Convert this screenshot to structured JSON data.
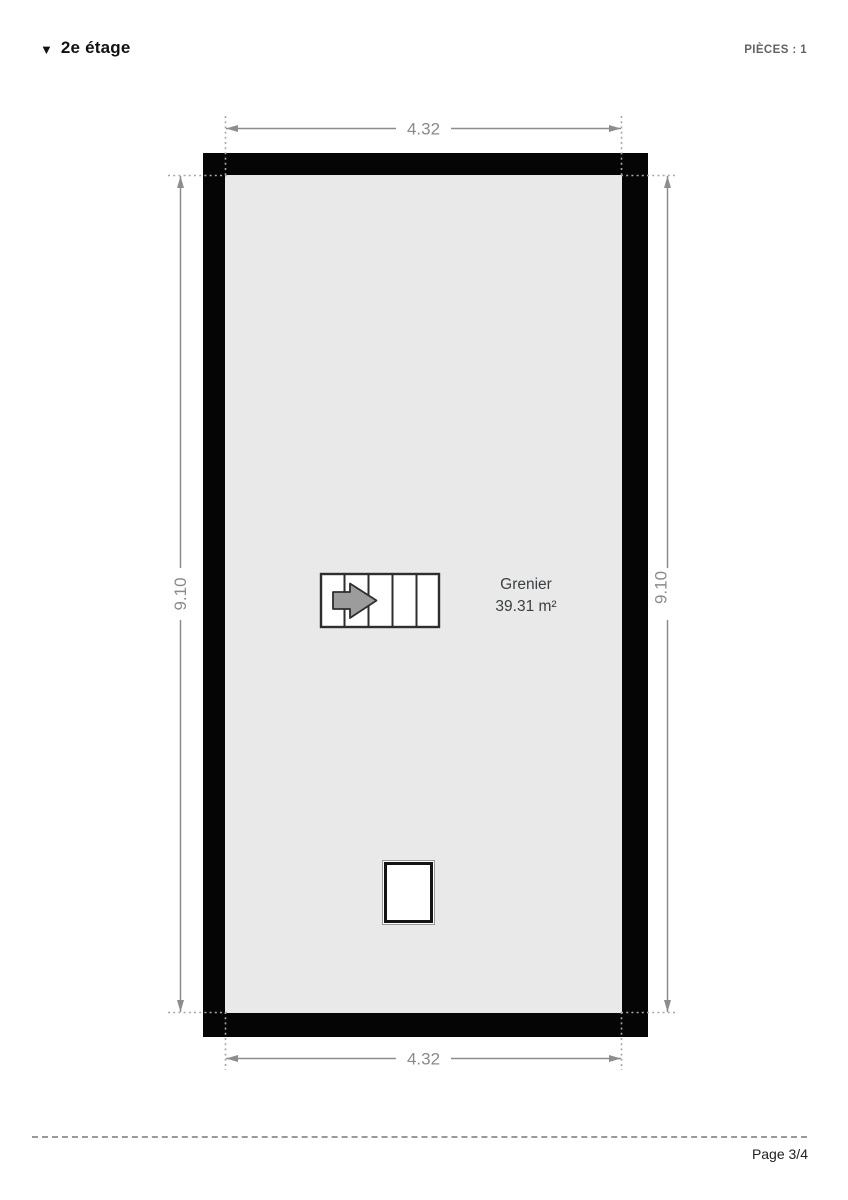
{
  "header": {
    "collapse_icon": "▼",
    "floor_title": "2e étage",
    "rooms_count_label": "PIÈCES : 1"
  },
  "plan": {
    "room": {
      "name": "Grenier",
      "area": "39.31 m²"
    },
    "dimensions": {
      "top_width": "4.32",
      "bottom_width": "4.32",
      "left_height": "9.10",
      "right_height": "9.10"
    }
  },
  "footer": {
    "page_label": "Page 3/4"
  },
  "colors": {
    "wall": "#050505",
    "floor": "#e9e9e9",
    "dimension_gray": "#8d8d8d",
    "room_text": "#3c4043",
    "stairs_arrow_fill": "#9c9c9c"
  }
}
